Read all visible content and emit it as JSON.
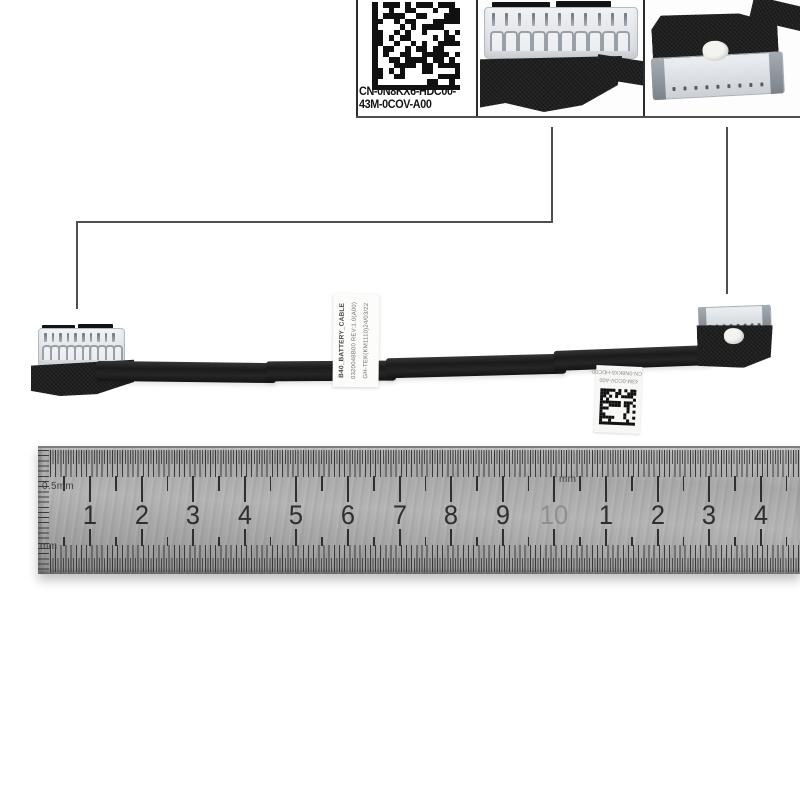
{
  "part_label": {
    "line1": "CN-0N8KX6-HDC00-",
    "line2": "43M-0COV-A00"
  },
  "flag_label": {
    "line1": "B40_BATTERY_CABLE",
    "line2": "0320048B00  REV:1.0(A00)",
    "line3": "GH-TEK(KM1110)24/03/22"
  },
  "hang_tag": {
    "line1": "CN-0N8KX6-HDC00-",
    "line2": "43M-0COV-A00"
  },
  "ruler": {
    "label_top_scale": "0.5mm",
    "label_bottom_scale": "mm",
    "label_mid_scale": "mm",
    "numbers": [
      "1",
      "2",
      "3",
      "4",
      "5",
      "6",
      "7",
      "8",
      "9",
      "10",
      "1",
      "2",
      "3",
      "4"
    ],
    "faded_number_index": 9
  },
  "connectors": {
    "inset_left": {
      "pins": 11,
      "slots": 10
    },
    "inset_right": {
      "pin_dots": 9
    },
    "cable_left": {
      "pins": 10,
      "slots": 10
    },
    "cable_right": {
      "pin_dots": 8
    }
  },
  "colors": {
    "border": "#2b2b2b",
    "leader_line": "#4f4f4f",
    "cable": "#1f1f1f",
    "ruler_number": "#2e2e2e",
    "ruler_number_faded": "#8e8e8e"
  }
}
